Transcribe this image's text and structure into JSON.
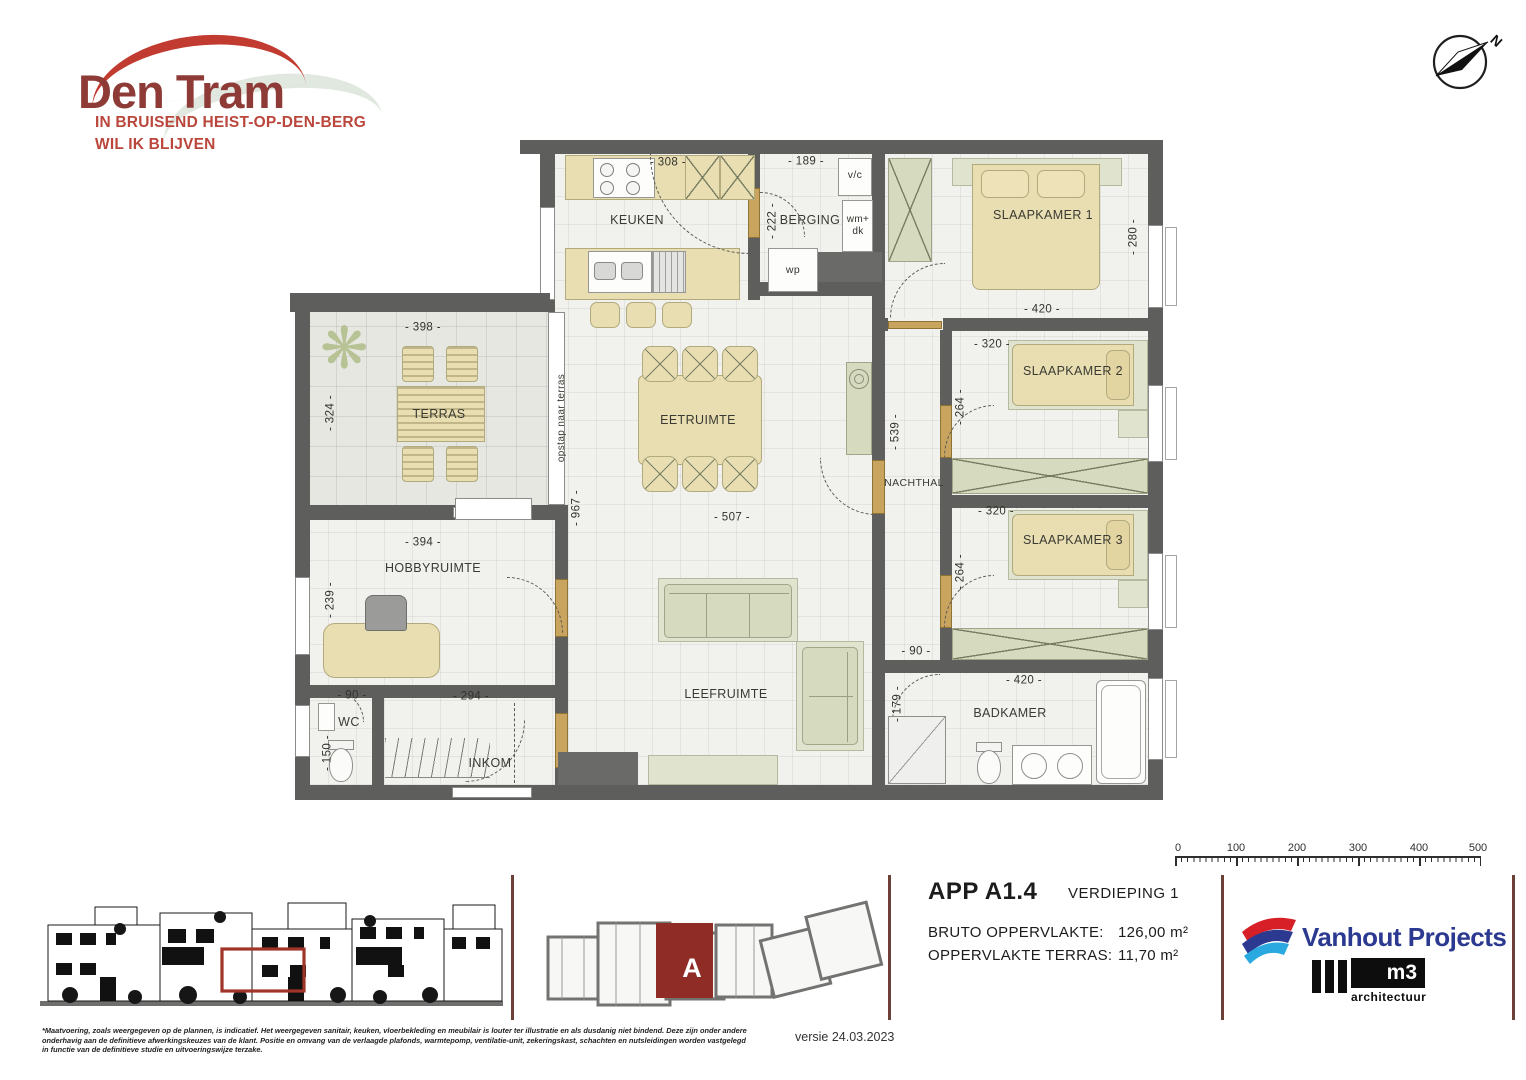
{
  "logo": {
    "title": "Den Tram",
    "tagline_line1": "IN BRUISEND HEIST-OP-DEN-BERG",
    "tagline_line2": "WIL IK BLIJVEN"
  },
  "compass": {
    "north_label": "N"
  },
  "plan": {
    "rooms": {
      "keuken": {
        "name": "KEUKEN",
        "dim_width": "- 308 -"
      },
      "berging": {
        "name": "BERGING",
        "dim_width": "- 189 -",
        "dim_height": "- 222 -",
        "vc_label": "v/c",
        "wm_line1": "wm+",
        "wm_line2": "dk",
        "wp_label": "wp"
      },
      "slaapkamer1": {
        "name": "SLAAPKAMER 1",
        "dim_width": "- 420 -",
        "dim_height": "- 280 -"
      },
      "slaapkamer2": {
        "name": "SLAAPKAMER 2",
        "dim_width": "- 320 -",
        "dim_height": "- 264 -"
      },
      "slaapkamer3": {
        "name": "SLAAPKAMER 3",
        "dim_width": "- 320 -",
        "dim_height": "- 264 -"
      },
      "nachthal": {
        "name": "NACHTHAL",
        "dim_height": "- 539 -",
        "dim_width": "- 90 -"
      },
      "badkamer": {
        "name": "BADKAMER",
        "dim_width": "- 420 -",
        "dim_height": "- 179 -"
      },
      "terras": {
        "name": "TERRAS",
        "dim_width": "- 398 -",
        "dim_height": "- 324 -",
        "note": "opstap naar terras"
      },
      "eetruimte": {
        "name": "EETRUIMTE",
        "dim_width": "- 507 -",
        "dim_height": "- 967 -"
      },
      "leefruimte": {
        "name": "LEEFRUIMTE"
      },
      "hobbyruimte": {
        "name": "HOBBYRUIMTE",
        "dim_width": "- 394 -",
        "dim_height": "- 239 -"
      },
      "wc": {
        "name": "WC",
        "dim_width": "- 90 -",
        "dim_height": "- 150 -"
      },
      "inkom": {
        "name": "INKOM",
        "dim_width": "- 294 -"
      }
    }
  },
  "info": {
    "apartment": "APP A1.4",
    "floor": "VERDIEPING 1",
    "area_label": "BRUTO OPPERVLAKTE:",
    "area_value": "126,00 m²",
    "terrace_label": "OPPERVLAKTE TERRAS:",
    "terrace_value": "11,70 m²",
    "version": "versie 24.03.2023"
  },
  "site_plan": {
    "unit_label": "A"
  },
  "scale_bar": {
    "ticks": [
      "0",
      "100",
      "200",
      "300",
      "400",
      "500"
    ]
  },
  "branding": {
    "developer": "Vanhout Projects",
    "architect_name": "m3",
    "architect_sub": "architectuur"
  },
  "disclaimer": "*Maatvoering, zoals weergegeven op de plannen, is indicatief. Het weergegeven sanitair, keuken, vloerbekleding en meubilair is louter ter illustratie en als dusdanig niet bindend. Deze zijn onder andere onderhavig aan de definitieve afwerkingskeuzes van de klant. Positie en omvang van de verlaagde plafonds, warmtepomp, ventilatie-unit, zekeringskast, schachten en nutsleidingen worden vastgelegd in functie van de definitieve studie en uitvoeringswijze terzake.",
  "colors": {
    "wall": "#5e5e5d",
    "highlight_red": "#8f2c26",
    "logo_red": "#c23b31",
    "logo_maroon": "#8e3b37",
    "developer_navy": "#2b3990"
  }
}
